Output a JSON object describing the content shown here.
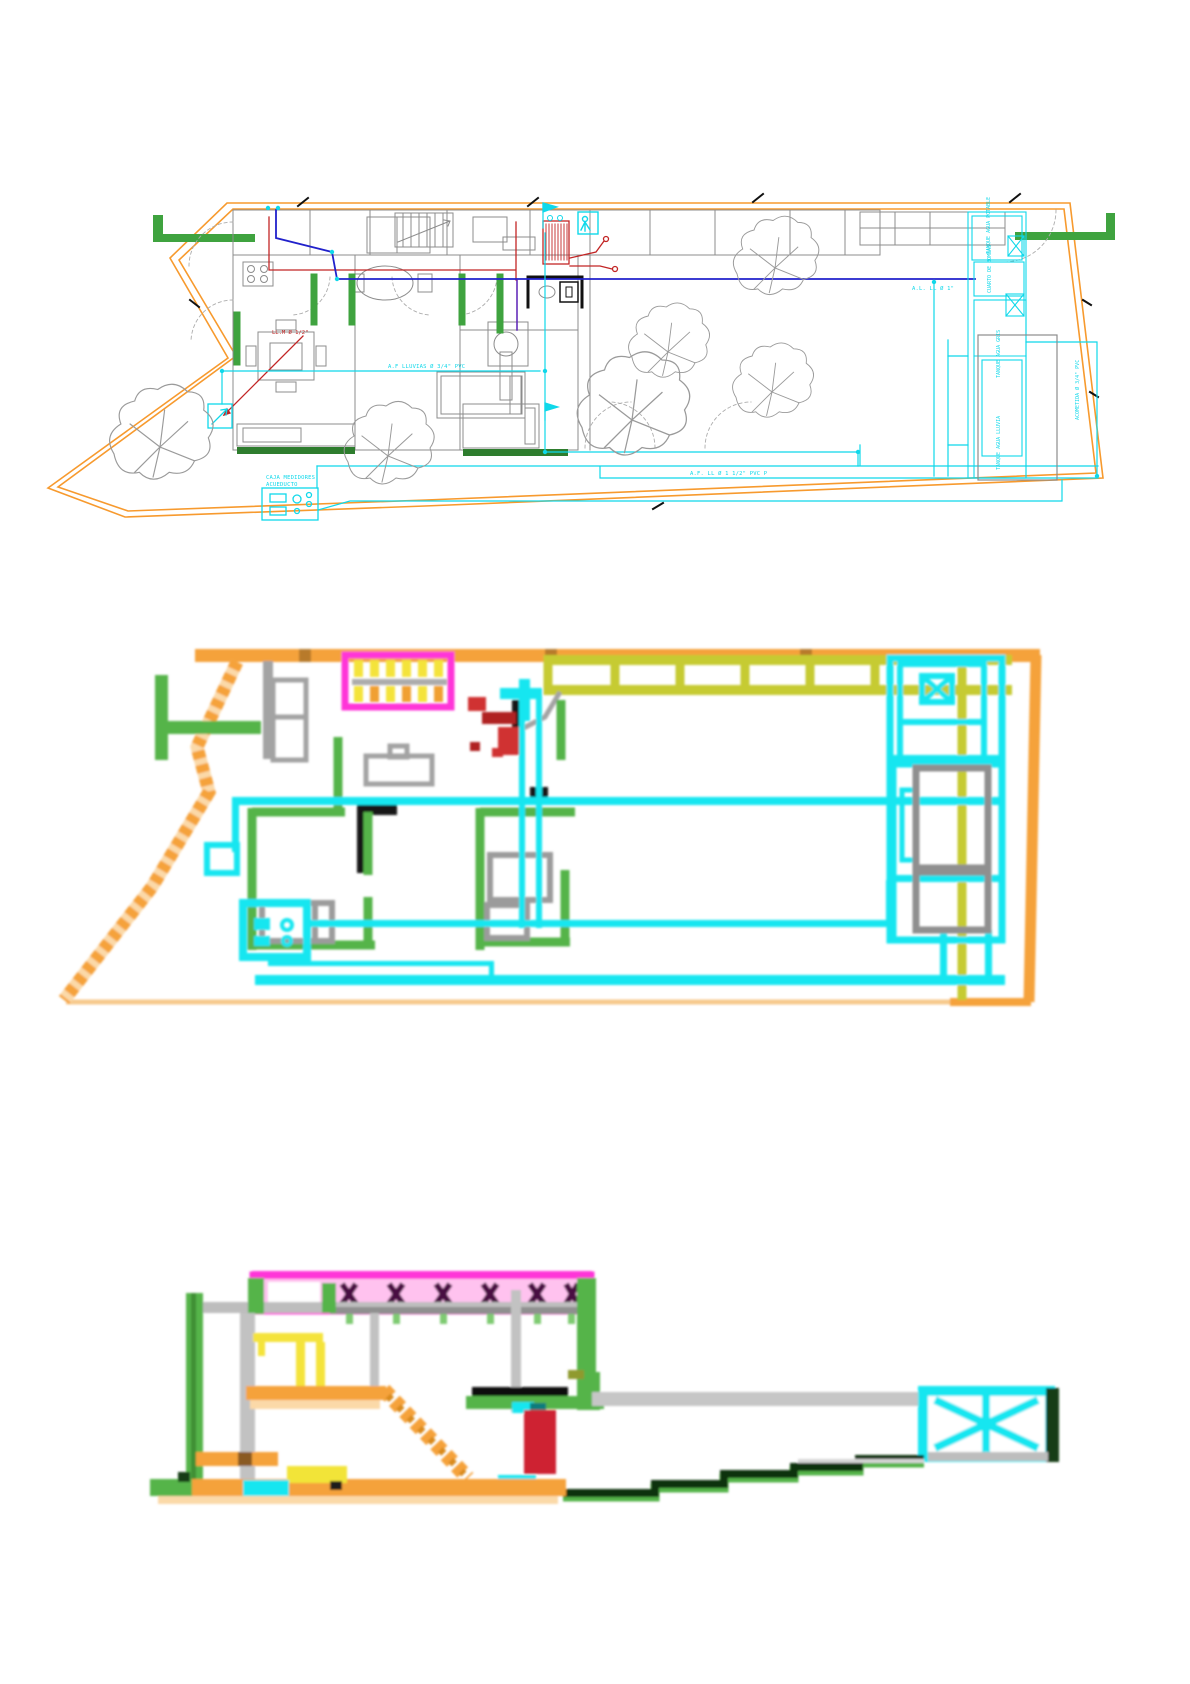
{
  "page": {
    "title": "Plano instalaciones hidráulicas - planta y cortes",
    "background": "#FFFFFF"
  },
  "figures": {
    "site_plan": {
      "name": "planta-instalaciones-cad",
      "labels": {
        "rain_pipe": "A.F LLUVIAS Ø 3/4\" PVC",
        "hot_water": "LL.M Ø 1/2\"",
        "meter_box_line1": "CAJA MEDIDORES",
        "meter_box_line2": "ACUEDUCTO",
        "bottom_pipe": "A.F. LL Ø 1 1/2\" PVC P",
        "right_pipe": "A.L. LL Ø 1\"",
        "tank_potable": "TANQUE AGUA POTABLE",
        "pump_room": "CUARTO DE BOMBAS",
        "tank_gray": "TANQUE AGUA GRIS",
        "tank_rain": "TANQUE AGUA LLUVIA",
        "acometida": "ACOMETIDA Ø 3/4\" PVC"
      }
    },
    "pixel_plan": {
      "name": "planta-esquema-color-pixelada"
    },
    "pixel_section": {
      "name": "corte-esquema-color-pixelado"
    }
  },
  "palette": {
    "boundary_orange": "#F5A23B",
    "light_orange": "#FBD9A8",
    "wall_green": "#55B44A",
    "dark_green": "#143D14",
    "pipe_cyan": "#18E6F0",
    "cad_cyan": "#0FD8EA",
    "hot_red": "#CC2020",
    "supply_blue": "#2121CB",
    "roof_magenta": "#FF35D8",
    "pink_fill": "#FFC2EF",
    "stair_yellow": "#F4E33B",
    "pergola_olive": "#C6CB33",
    "cad_gray": "#8C8C8C",
    "slab_gray": "#C6C6C6"
  }
}
